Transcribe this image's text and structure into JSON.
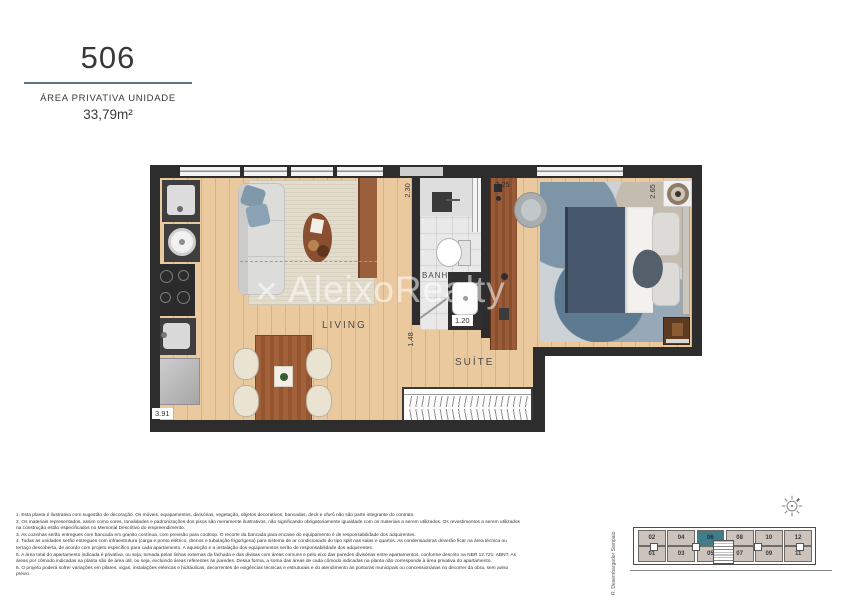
{
  "header": {
    "unit_number": "506",
    "area_label": "ÁREA PRIVATIVA UNIDADE",
    "area_value": "33,79m²"
  },
  "plan": {
    "labels": {
      "living": "LIVING",
      "bathroom": "BANH.",
      "suite": "SUÍTE"
    },
    "dimensions": {
      "living_width": "3.90",
      "kitchen_width": "3.91",
      "bath_height": "2.30",
      "bath_vanity_width": "1.20",
      "bath_door": "1.48",
      "closet_width": "3.25",
      "suite_depth": "2.65"
    },
    "watermark_logo": "✕",
    "watermark_text": "AleixoRealty"
  },
  "notes": [
    "1. Esta planta é ilustrativa com sugestão de decoração. Os móveis, equipamentos, divisórias, vegetação, objetos decorativos, bancadas, deck e ofurô não são parte integrante do contrato.",
    "2. Os materiais representados, assim como cores, tonalidades e padronizações dos pisos são meramente ilustrativos, não significando obrigatoriamente igualdade com os materiais a serem utilizados. Os revestimentos a serem utilizados na construção estão especificados no Memorial Descritivo do empreendimento.",
    "3. As cozinhas serão entregues com bancada em granito contínua, com previsão para cooktop. O recorte da bancada para encaixe do equipamento é de responsabilidade dos adquirentes.",
    "4. Todas as unidades serão entregues com infraestrutura (carga e ponto elétrico, drenos e tubulação frigorígena) para sistema de ar condicionado do tipo split nas salas e quartos. As condensadoras deverão ficar na área técnica ou terraço descoberta, de acordo com projeto específico para cada apartamento. A aquisição e a instalação dos equipamentos serão de responsabilidade dos adquirentes.",
    "5. A área total do apartamento indicada é privativa, ou seja, tomada pelas linhas externas da fachada e das divisas com áreas comuns e pelo eixo das paredes divisórias entre apartamentos, conforme descrito na NBR 12.721: ABNT. As áreas por cômodo indicadas na planta são de área útil, ou seja, excluindo áreas referentes às paredes. Dessa forma, a soma das áreas de cada cômodo indicadas na planta não corresponde à área privativa do apartamento.",
    "6. O projeto poderá sofrer variações em pilares, vigas, instalações elétricas e hidráulicas, decorrentes de exigências técnicas e estruturais e do atendimento às posturas municipais ou concessionárias no decorrer da obra, sem aviso prévio."
  ],
  "keyplan": {
    "street_label": "R. Desembargador Sampaio",
    "units_top": [
      "02",
      "04",
      "06",
      "08",
      "10",
      "12"
    ],
    "units_bottom": [
      "01",
      "03",
      "05",
      "07",
      "09",
      "11"
    ],
    "highlighted_unit": "06"
  },
  "colors": {
    "wall": "#2d2d2d",
    "wood": "#eac99f",
    "wood-line": "#d9b186",
    "accent-rule": "#5d7683",
    "keyplan-unit": "#ccc4bc",
    "keyplan-highlight": "#417d89",
    "text": "#3a3a3a"
  }
}
